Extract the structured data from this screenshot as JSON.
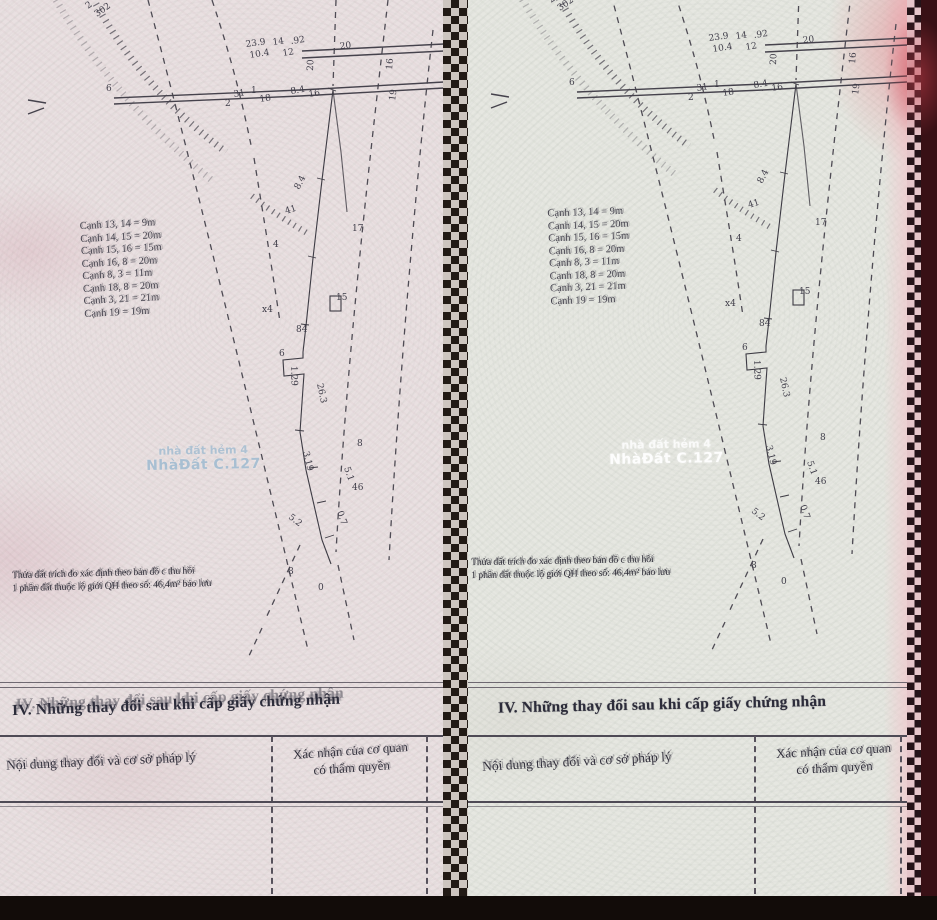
{
  "document": {
    "section_iv_title": "IV. Những thay đổi sau khi cấp giấy chứng nhận",
    "table": {
      "col1_header": "Nội dung thay đổi và cơ sở pháp lý",
      "col2_header_line1": "Xác nhận của cơ quan",
      "col2_header_line2": "có thẩm quyền"
    },
    "measurements": [
      "Cạnh 13, 14 = 9m",
      "Cạnh 14, 15 = 20m",
      "Cạnh 15, 16 = 15m",
      "Cạnh 16, 8 = 20m",
      "Cạnh 8, 3 = 11m",
      "Cạnh 18, 8 = 20m",
      "Cạnh 3, 21 = 21m",
      "Cạnh 19 = 19m"
    ],
    "note_line1": "Thửa đất trích đo xác định theo bản đồ c thu hồi",
    "note_line2": "1 phần đất thuộc lộ giới QH theo số: 46,4m² bảo lưu",
    "watermark_line1": "nhà đất hẻm 4",
    "watermark_line2": "NhàĐất C.127",
    "diagram_labels": [
      {
        "t": "2",
        "x": 88,
        "y": 9,
        "r": -35
      },
      {
        "t": "302",
        "x": 97,
        "y": 17,
        "r": -35
      },
      {
        "t": "6",
        "x": 106,
        "y": 91,
        "r": 0
      },
      {
        "t": "23.9",
        "x": 246,
        "y": 47,
        "r": -8
      },
      {
        "t": "14",
        "x": 273,
        "y": 45,
        "r": -8
      },
      {
        "t": ".92",
        "x": 291,
        "y": 44,
        "r": -8
      },
      {
        "t": "20",
        "x": 340,
        "y": 49,
        "r": -6
      },
      {
        "t": "10.4",
        "x": 250,
        "y": 58,
        "r": -9
      },
      {
        "t": "12",
        "x": 283,
        "y": 56,
        "r": -9
      },
      {
        "t": "16",
        "x": 392,
        "y": 70,
        "r": -85
      },
      {
        "t": "19",
        "x": 395,
        "y": 101,
        "r": -82
      },
      {
        "t": "20",
        "x": 313,
        "y": 71,
        "r": -88
      },
      {
        "t": "31",
        "x": 234,
        "y": 97,
        "r": -9
      },
      {
        "t": "1",
        "x": 251,
        "y": 93,
        "r": 0
      },
      {
        "t": "18",
        "x": 260,
        "y": 102,
        "r": -9
      },
      {
        "t": "8.4",
        "x": 291,
        "y": 94,
        "r": -9
      },
      {
        "t": "16",
        "x": 309,
        "y": 97,
        "r": -9
      },
      {
        "t": "2",
        "x": 225,
        "y": 106,
        "r": 0
      },
      {
        "t": "17",
        "x": 352,
        "y": 231,
        "r": 0
      },
      {
        "t": "8.4",
        "x": 299,
        "y": 190,
        "r": -62
      },
      {
        "t": "41",
        "x": 286,
        "y": 214,
        "r": -18
      },
      {
        "t": "4",
        "x": 273,
        "y": 247,
        "r": 0
      },
      {
        "t": "x4",
        "x": 262,
        "y": 312,
        "r": 0
      },
      {
        "t": "15",
        "x": 336,
        "y": 300,
        "r": 0
      },
      {
        "t": "84",
        "x": 296,
        "y": 332,
        "r": 0
      },
      {
        "t": "6",
        "x": 279,
        "y": 356,
        "r": 0
      },
      {
        "t": "1.29",
        "x": 291,
        "y": 366,
        "r": 88
      },
      {
        "t": "26.3",
        "x": 317,
        "y": 384,
        "r": 78
      },
      {
        "t": "8",
        "x": 357,
        "y": 446,
        "r": 0
      },
      {
        "t": "3.19",
        "x": 303,
        "y": 452,
        "r": 76
      },
      {
        "t": "5.1",
        "x": 344,
        "y": 468,
        "r": 70
      },
      {
        "t": "46",
        "x": 352,
        "y": 490,
        "r": 0
      },
      {
        "t": "5.2",
        "x": 288,
        "y": 518,
        "r": 38
      },
      {
        "t": "0.7",
        "x": 337,
        "y": 512,
        "r": 70
      },
      {
        "t": "8",
        "x": 288,
        "y": 574,
        "r": 0
      },
      {
        "t": "0",
        "x": 318,
        "y": 590,
        "r": 0
      }
    ]
  },
  "colors": {
    "background_maroon": "#30100f",
    "paper_left": "#e9e0e1",
    "paper_right": "#e6e7e1",
    "ink": "#3d3b44",
    "table_line": "#4e4a55",
    "perforation_dark": "#221a15",
    "pink_edge": "#e5c6ca",
    "watermark_left": "#a8bfd2",
    "watermark_right": "#fdfdfd",
    "bottom_strip": "#120c09"
  }
}
